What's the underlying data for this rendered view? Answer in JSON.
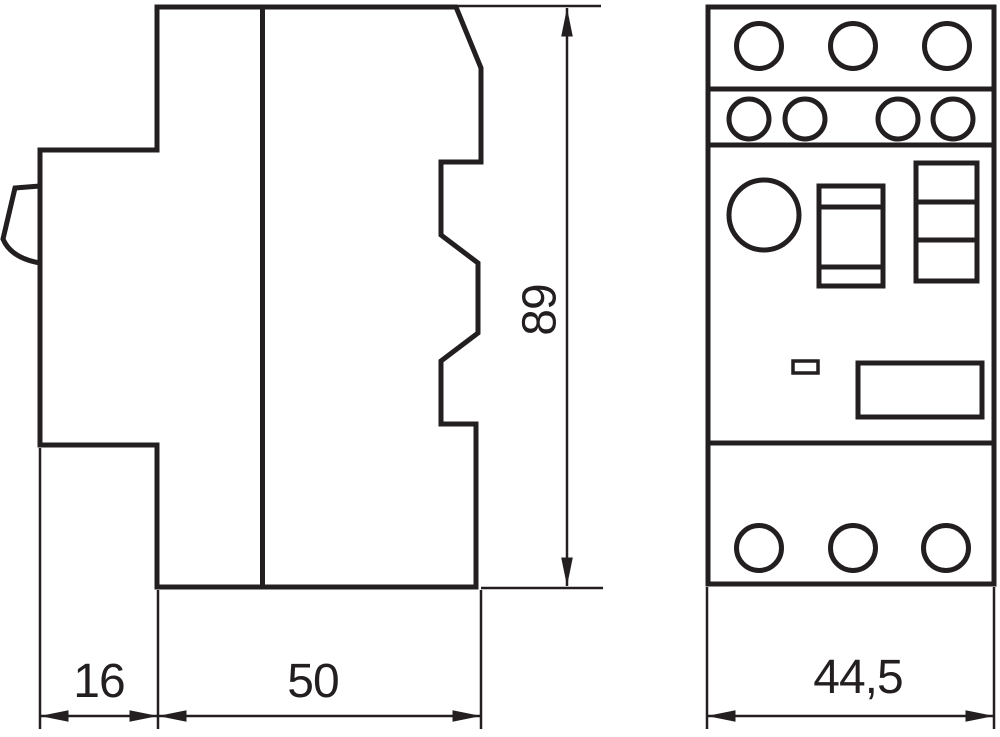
{
  "drawing": {
    "dimension_labels": {
      "clip_depth": "16",
      "body_depth": "50",
      "height": "89",
      "front_width": "44,5"
    },
    "colors": {
      "line": "#231f20",
      "background": "#ffffff"
    }
  }
}
